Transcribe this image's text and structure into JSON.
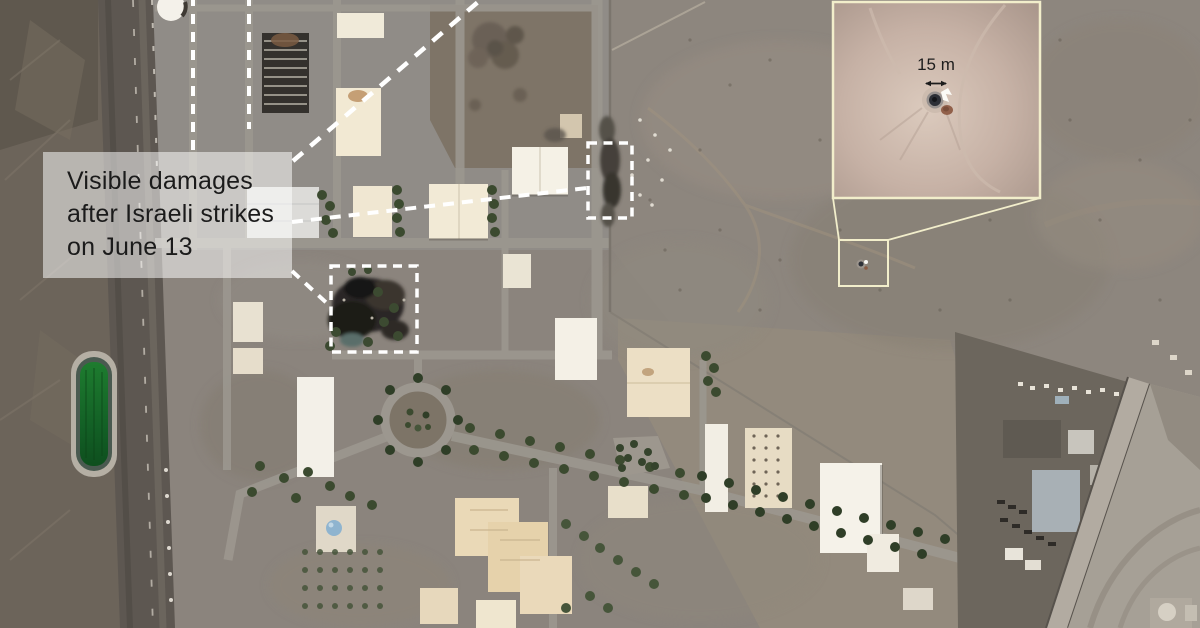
{
  "label": {
    "lines": [
      "Visible damages",
      "after Israeli strikes",
      "on June 13"
    ]
  },
  "inset": {
    "scale_label": "15 m"
  },
  "colors": {
    "annotation_white": "#ffffff",
    "label_text": "#1b1b1b",
    "label_background": "rgba(255,255,255,0.52)",
    "inset_border": "#f2eecb",
    "pond_green": "#1e7c2f",
    "tree_green": "#3b4a2f",
    "terrain_gray": "#8c8780",
    "desert_tan": "#8d867e",
    "burn_dark": "#232120"
  }
}
